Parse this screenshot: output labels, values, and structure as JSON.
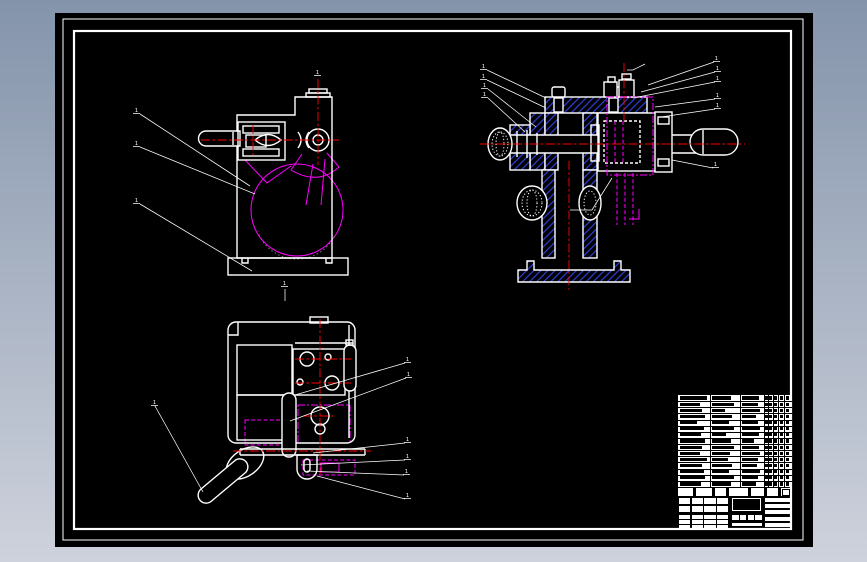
{
  "document": {
    "kind": "cad-assembly-drawing",
    "sheet": "three-view mechanical assembly drawing with parts list and title block"
  },
  "colors": {
    "background_top": "#8494ab",
    "background_bottom": "#ced2dc",
    "paper": "#000000",
    "line": "#ffffff",
    "centerline": "#ff0000",
    "phantom": "#ff00ff",
    "hatch_blue": "#2e3fd6",
    "dim_gray": "#7a7a7a"
  },
  "views": {
    "front_view": {
      "balloons": [
        {
          "text": "1",
          "x": 80,
          "y": 99,
          "line": [
            [
              85,
              101
            ],
            [
              195,
              173
            ]
          ]
        },
        {
          "text": "1",
          "x": 80,
          "y": 132,
          "line": [
            [
              85,
              134
            ],
            [
              200,
              181
            ]
          ]
        },
        {
          "text": "1",
          "x": 80,
          "y": 189,
          "line": [
            [
              85,
              191
            ],
            [
              197,
              258
            ]
          ]
        },
        {
          "text": "1",
          "x": 261,
          "y": 61,
          "line": []
        }
      ]
    },
    "section_view": {
      "balloons": [
        {
          "text": "1",
          "x": 427,
          "y": 55,
          "line": [
            [
              432,
              57
            ],
            [
              491,
              85
            ]
          ]
        },
        {
          "text": "1",
          "x": 427,
          "y": 65,
          "line": [
            [
              432,
              67
            ],
            [
              491,
              95
            ]
          ]
        },
        {
          "text": "1",
          "x": 428,
          "y": 74,
          "line": [
            [
              433,
              76
            ],
            [
              481,
              114
            ]
          ]
        },
        {
          "text": "1",
          "x": 428,
          "y": 83,
          "line": [
            [
              433,
              85
            ],
            [
              470,
              119
            ]
          ]
        },
        {
          "text": "1",
          "x": 660,
          "y": 47,
          "line": [
            [
              659,
              49
            ],
            [
              593,
              72
            ]
          ]
        },
        {
          "text": "1",
          "x": 661,
          "y": 57,
          "line": [
            [
              660,
              59
            ],
            [
              586,
              79
            ]
          ]
        },
        {
          "text": "1",
          "x": 661,
          "y": 67,
          "line": [
            [
              660,
              69
            ],
            [
              578,
              85
            ]
          ]
        },
        {
          "text": "1",
          "x": 661,
          "y": 84,
          "line": [
            [
              660,
              86
            ],
            [
              600,
              94
            ]
          ]
        },
        {
          "text": "1",
          "x": 661,
          "y": 94,
          "line": [
            [
              660,
              96
            ],
            [
              606,
              104
            ]
          ]
        },
        {
          "text": "1",
          "x": 659,
          "y": 153,
          "line": [
            [
              658,
              155
            ],
            [
              617,
              147
            ]
          ]
        }
      ]
    },
    "top_view": {
      "balloons": [
        {
          "text": "1",
          "x": 351,
          "y": 348,
          "line": [
            [
              350,
              350
            ],
            [
              240,
              382
            ]
          ]
        },
        {
          "text": "1",
          "x": 352,
          "y": 363,
          "line": [
            [
              351,
              365
            ],
            [
              235,
              408
            ]
          ]
        },
        {
          "text": "1",
          "x": 351,
          "y": 428,
          "line": [
            [
              350,
              430
            ],
            [
              258,
              440
            ]
          ]
        },
        {
          "text": "1",
          "x": 351,
          "y": 445,
          "line": [
            [
              350,
              447
            ],
            [
              246,
              452
            ]
          ]
        },
        {
          "text": "1",
          "x": 350,
          "y": 460,
          "line": [
            [
              349,
              462
            ],
            [
              252,
              458
            ]
          ]
        },
        {
          "text": "1",
          "x": 351,
          "y": 484,
          "line": [
            [
              350,
              486
            ],
            [
              262,
              463
            ]
          ]
        },
        {
          "text": "1",
          "x": 98,
          "y": 391,
          "line": [
            [
              100,
              393
            ],
            [
              148,
              479
            ]
          ]
        },
        {
          "text": "1",
          "x": 228,
          "y": 272,
          "line": [
            [
              230,
              276
            ],
            [
              230,
              288
            ]
          ]
        }
      ]
    }
  },
  "bom": {
    "row_count": 15,
    "rows": [
      [
        0.95,
        0.8,
        0.85
      ],
      [
        0.7,
        0.9,
        0.8
      ],
      [
        0.8,
        0.55,
        0.9
      ],
      [
        0.9,
        0.85,
        0.7
      ],
      [
        0.6,
        0.7,
        0.8
      ],
      [
        0.85,
        0.9,
        0.9
      ],
      [
        0.75,
        0.6,
        0.85
      ],
      [
        0.9,
        0.8,
        0.6
      ],
      [
        0.8,
        0.9,
        0.85
      ],
      [
        0.7,
        0.75,
        0.9
      ],
      [
        0.95,
        0.65,
        0.8
      ],
      [
        0.8,
        0.85,
        0.75
      ],
      [
        0.85,
        0.7,
        0.9
      ],
      [
        0.9,
        0.9,
        0.8
      ],
      [
        0.75,
        0.8,
        0.7
      ]
    ],
    "text_col_x": [
      2,
      34,
      64
    ],
    "text_col_w": [
      28,
      24,
      20
    ],
    "tick_col_x": [
      87,
      91,
      96,
      102,
      108
    ],
    "col_separators": [
      32,
      62,
      86,
      90,
      95,
      100,
      106
    ],
    "header_gaps": [
      15,
      34,
      48,
      70,
      86,
      100
    ]
  },
  "title_block": {
    "left_cols": 4,
    "left_top_rows": 2,
    "left_thin_rows": 3,
    "stamp_cells": 4,
    "right_rows": 5
  }
}
